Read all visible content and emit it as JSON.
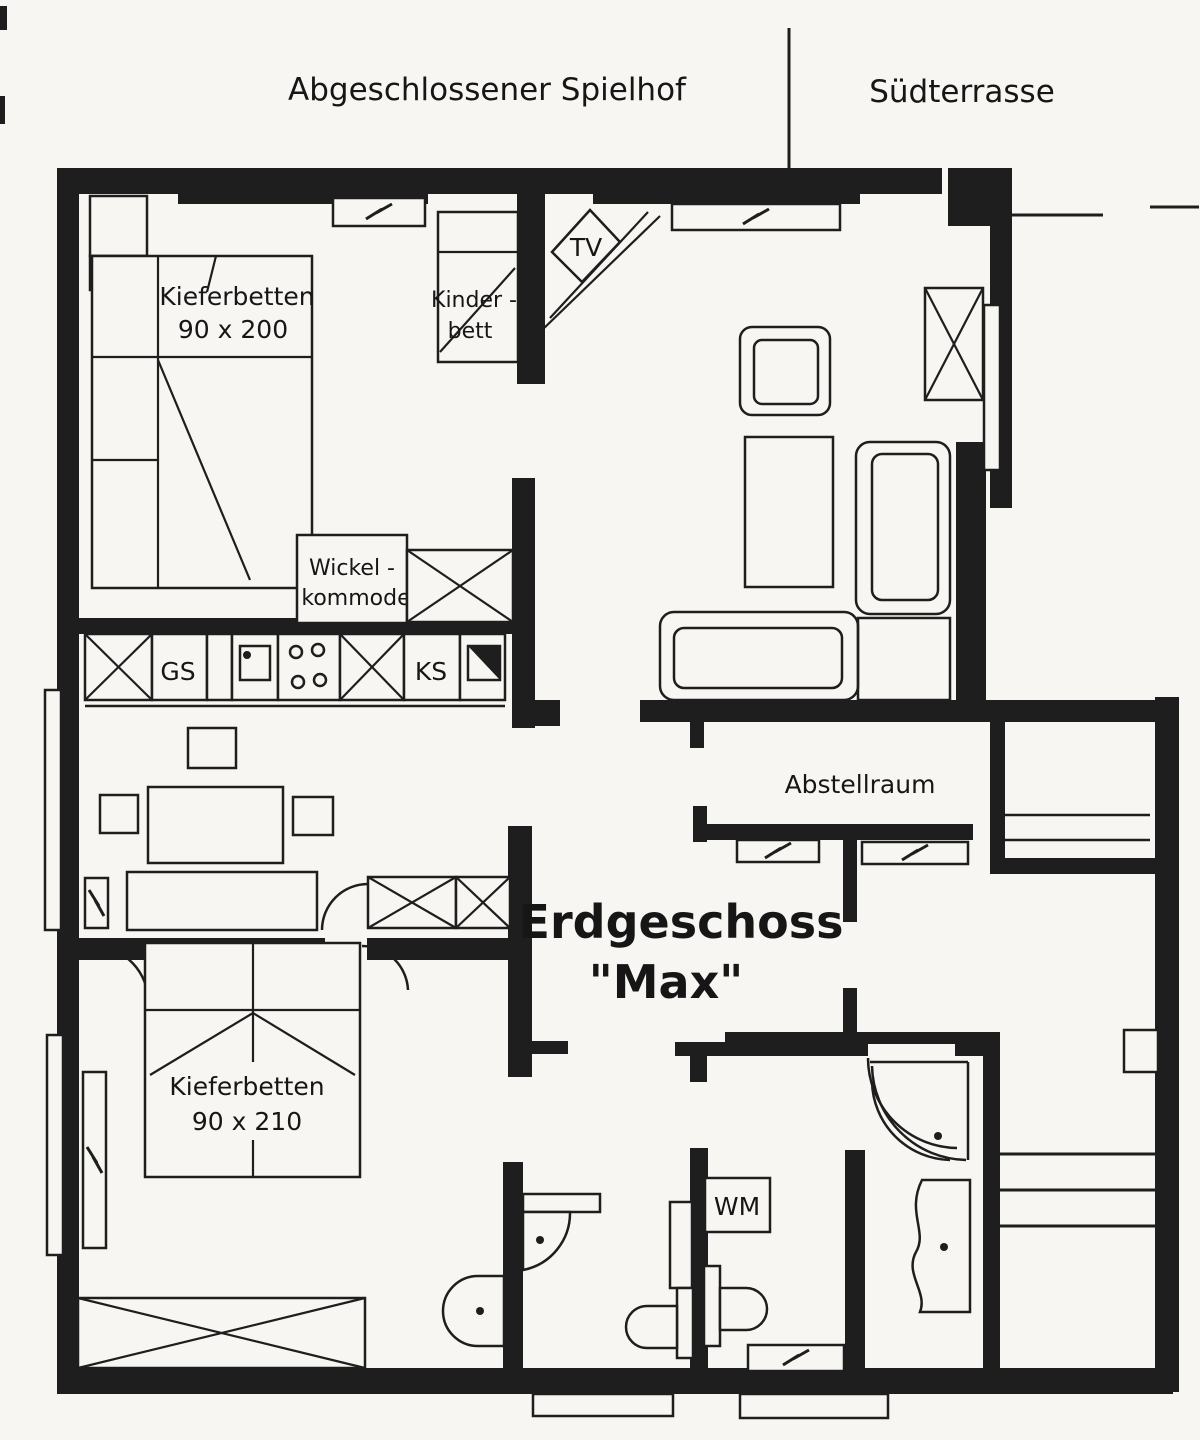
{
  "colors": {
    "ink": "#1e1e1e",
    "paper": "#f7f6f2"
  },
  "site": {
    "play_yard": "Abgeschlossener Spielhof",
    "south_terrace": "Südterrasse"
  },
  "plan_title": {
    "line1": "Erdgeschoss",
    "line2": "\"Max\""
  },
  "labels": {
    "beds_top": {
      "line1": "Kieferbetten",
      "line2": "90 x 200"
    },
    "child_bed": {
      "line1": "Kinder -",
      "line2": "bett"
    },
    "tv": "TV",
    "changing_table": {
      "line1": "Wickel -",
      "line2": "kommode"
    },
    "dishwasher": "GS",
    "fridge": "KS",
    "storage_room": "Abstellraum",
    "beds_bottom": {
      "line1": "Kieferbetten",
      "line2": "90 x 210"
    },
    "washing_machine": "WM"
  }
}
